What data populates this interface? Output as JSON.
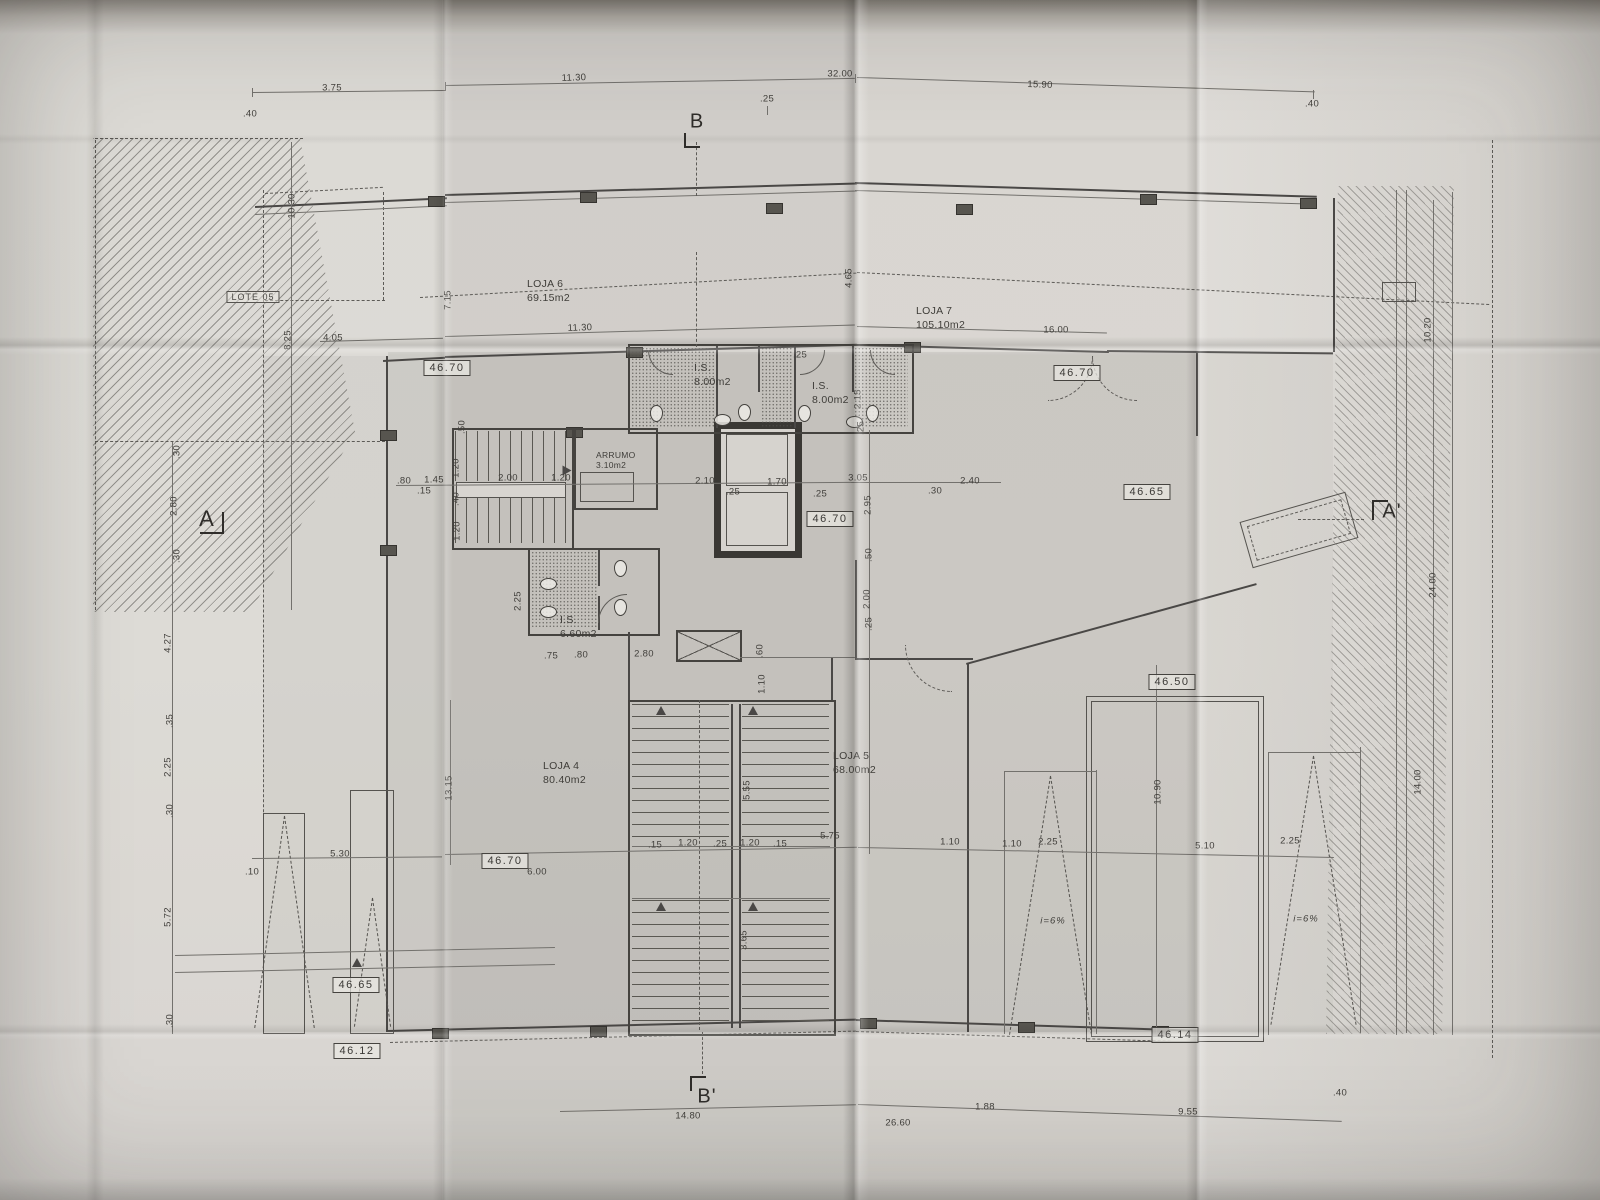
{
  "drawing": {
    "type": "architectural-floor-plan-photograph",
    "section_markers": [
      {
        "label": "B",
        "x": 697,
        "y": 122
      },
      {
        "label": "B'",
        "x": 707,
        "y": 1097
      },
      {
        "label": "A",
        "x": 207,
        "y": 519
      },
      {
        "label": "A'",
        "x": 1392,
        "y": 512
      }
    ],
    "lot_label": {
      "text": "LOTE 05",
      "x": 253,
      "y": 297
    },
    "rooms": [
      {
        "name": "LOJA 6",
        "area": "69.15m2",
        "x": 527,
        "y": 278
      },
      {
        "name": "LOJA 7",
        "area": "105.10m2",
        "x": 916,
        "y": 305
      },
      {
        "name": "LOJA 4",
        "area": "80.40m2",
        "x": 543,
        "y": 760
      },
      {
        "name": "LOJA 5",
        "area": "68.00m2",
        "x": 833,
        "y": 750
      },
      {
        "name": "I.S.",
        "area": "8.00m2",
        "x": 694,
        "y": 362
      },
      {
        "name": "I.S.",
        "area": "8.00m2",
        "x": 812,
        "y": 380
      },
      {
        "name": "I.S.",
        "area": "6.60m2",
        "x": 560,
        "y": 614
      },
      {
        "name": "ARRUMO",
        "area": "3.10m2",
        "x": 596,
        "y": 450,
        "small": true
      }
    ],
    "elevation_marks": [
      {
        "t": "46.70",
        "x": 447,
        "y": 368
      },
      {
        "t": "46.70",
        "x": 1077,
        "y": 373
      },
      {
        "t": "46.65",
        "x": 1147,
        "y": 492
      },
      {
        "t": "46.70",
        "x": 830,
        "y": 519
      },
      {
        "t": "46.50",
        "x": 1172,
        "y": 682
      },
      {
        "t": "46.70",
        "x": 505,
        "y": 861
      },
      {
        "t": "46.65",
        "x": 356,
        "y": 985
      },
      {
        "t": "46.12",
        "x": 357,
        "y": 1051
      },
      {
        "t": "46.14",
        "x": 1175,
        "y": 1035
      }
    ],
    "slope_labels": [
      {
        "t": "i=6%",
        "x": 1053,
        "y": 921
      },
      {
        "t": "i=6%",
        "x": 1306,
        "y": 919
      }
    ],
    "dimensions": [
      {
        "t": ".40",
        "x": 250,
        "y": 114
      },
      {
        "t": "3.75",
        "x": 332,
        "y": 88
      },
      {
        "t": "11.30",
        "x": 574,
        "y": 78,
        "r": -2
      },
      {
        "t": "32.00",
        "x": 840,
        "y": 74
      },
      {
        "t": ".25",
        "x": 767,
        "y": 99
      },
      {
        "t": "15.90",
        "x": 1040,
        "y": 85,
        "r": 2
      },
      {
        "t": ".40",
        "x": 1312,
        "y": 104
      },
      {
        "t": "4.05",
        "x": 333,
        "y": 338
      },
      {
        "t": "11.30",
        "x": 580,
        "y": 328,
        "r": -2
      },
      {
        "t": "16.00",
        "x": 1056,
        "y": 330
      },
      {
        "t": "10.30",
        "x": 292,
        "y": 206,
        "r": -90
      },
      {
        "t": "8.25",
        "x": 288,
        "y": 340,
        "r": -90
      },
      {
        "t": ".30",
        "x": 177,
        "y": 452,
        "r": -90
      },
      {
        "t": "2.80",
        "x": 174,
        "y": 506,
        "r": -90
      },
      {
        "t": ".30",
        "x": 177,
        "y": 556,
        "r": -90
      },
      {
        "t": "4.27",
        "x": 168,
        "y": 643,
        "r": -90
      },
      {
        "t": ".35",
        "x": 170,
        "y": 721,
        "r": -90
      },
      {
        "t": "2.25",
        "x": 168,
        "y": 767,
        "r": -90
      },
      {
        "t": ".30",
        "x": 170,
        "y": 811,
        "r": -90
      },
      {
        "t": "5.72",
        "x": 168,
        "y": 917,
        "r": -90
      },
      {
        "t": ".30",
        "x": 170,
        "y": 1021,
        "r": -90
      },
      {
        "t": "7.15",
        "x": 448,
        "y": 300,
        "r": -90
      },
      {
        "t": "4.65",
        "x": 849,
        "y": 278,
        "r": -90
      },
      {
        "t": "2.15",
        "x": 858,
        "y": 399,
        "r": -90
      },
      {
        "t": ".25",
        "x": 861,
        "y": 428,
        "r": -90
      },
      {
        "t": ".25",
        "x": 800,
        "y": 355
      },
      {
        "t": ".50",
        "x": 462,
        "y": 427,
        "r": -90
      },
      {
        "t": ".80",
        "x": 404,
        "y": 481
      },
      {
        "t": "1.45",
        "x": 434,
        "y": 480
      },
      {
        "t": ".15",
        "x": 424,
        "y": 491
      },
      {
        "t": "2.00",
        "x": 508,
        "y": 478
      },
      {
        "t": "1.20",
        "x": 561,
        "y": 478
      },
      {
        "t": "1.20",
        "x": 456,
        "y": 468,
        "r": -90
      },
      {
        "t": ".40",
        "x": 456,
        "y": 499,
        "r": -90
      },
      {
        "t": "1.20",
        "x": 457,
        "y": 531,
        "r": -90
      },
      {
        "t": "2.10",
        "x": 705,
        "y": 481
      },
      {
        "t": ".25",
        "x": 733,
        "y": 492
      },
      {
        "t": "1.70",
        "x": 777,
        "y": 482
      },
      {
        "t": ".25",
        "x": 820,
        "y": 494
      },
      {
        "t": "3.05",
        "x": 858,
        "y": 478
      },
      {
        "t": ".30",
        "x": 935,
        "y": 491
      },
      {
        "t": "2.40",
        "x": 970,
        "y": 481
      },
      {
        "t": "2.95",
        "x": 868,
        "y": 505,
        "r": -90
      },
      {
        "t": ".50",
        "x": 869,
        "y": 555,
        "r": -90
      },
      {
        "t": "2.00",
        "x": 867,
        "y": 599,
        "r": -90
      },
      {
        "t": ".25",
        "x": 869,
        "y": 624,
        "r": -90
      },
      {
        "t": "2.25",
        "x": 518,
        "y": 601,
        "r": -90
      },
      {
        "t": ".75",
        "x": 551,
        "y": 656
      },
      {
        "t": ".80",
        "x": 581,
        "y": 655
      },
      {
        "t": "2.80",
        "x": 644,
        "y": 654
      },
      {
        "t": ".60",
        "x": 760,
        "y": 651,
        "r": -90
      },
      {
        "t": "1.10",
        "x": 762,
        "y": 684,
        "r": -90
      },
      {
        "t": "13.15",
        "x": 449,
        "y": 788,
        "r": -90
      },
      {
        "t": "5.55",
        "x": 747,
        "y": 790,
        "r": -90
      },
      {
        "t": "3.65",
        "x": 744,
        "y": 940,
        "r": -90
      },
      {
        "t": "10.90",
        "x": 1158,
        "y": 792,
        "r": -90
      },
      {
        "t": ".10",
        "x": 252,
        "y": 872
      },
      {
        "t": "5.30",
        "x": 340,
        "y": 854
      },
      {
        "t": "6.00",
        "x": 537,
        "y": 872
      },
      {
        "t": ".15",
        "x": 655,
        "y": 845
      },
      {
        "t": "1.20",
        "x": 688,
        "y": 843
      },
      {
        "t": ".25",
        "x": 720,
        "y": 844
      },
      {
        "t": "1.20",
        "x": 750,
        "y": 843
      },
      {
        "t": ".15",
        "x": 780,
        "y": 844
      },
      {
        "t": "5.75",
        "x": 830,
        "y": 836
      },
      {
        "t": "1.10",
        "x": 950,
        "y": 842
      },
      {
        "t": "1.10",
        "x": 1012,
        "y": 844
      },
      {
        "t": "2.25",
        "x": 1048,
        "y": 842
      },
      {
        "t": "5.10",
        "x": 1205,
        "y": 846
      },
      {
        "t": "2.25",
        "x": 1290,
        "y": 841
      },
      {
        "t": "10.20",
        "x": 1428,
        "y": 330,
        "r": -90
      },
      {
        "t": "24.00",
        "x": 1433,
        "y": 585,
        "r": -90
      },
      {
        "t": "14.00",
        "x": 1418,
        "y": 782,
        "r": -90
      },
      {
        "t": "14.80",
        "x": 688,
        "y": 1116
      },
      {
        "t": "26.60",
        "x": 898,
        "y": 1123
      },
      {
        "t": "1.88",
        "x": 985,
        "y": 1107
      },
      {
        "t": "9.55",
        "x": 1188,
        "y": 1112
      },
      {
        "t": ".40",
        "x": 1340,
        "y": 1093
      }
    ]
  }
}
